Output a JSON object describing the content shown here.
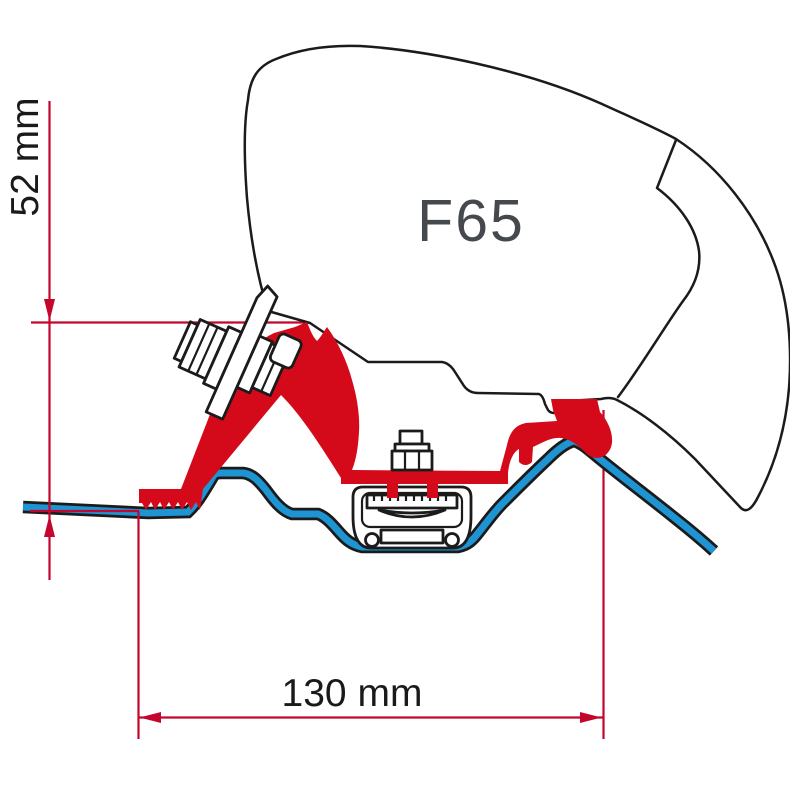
{
  "diagram": {
    "model_label": "F65",
    "dimensions": {
      "height": {
        "label": "52 mm"
      },
      "width": {
        "label": "130 mm"
      }
    },
    "colors": {
      "background": "#ffffff",
      "outline": "#1b1b1b",
      "bracket_red": "#d40a1a",
      "dimension_red": "#c4062e",
      "roof_blue": "#1e94d2",
      "label_gray": "#45494e",
      "text_black": "#1a1a1a"
    }
  }
}
